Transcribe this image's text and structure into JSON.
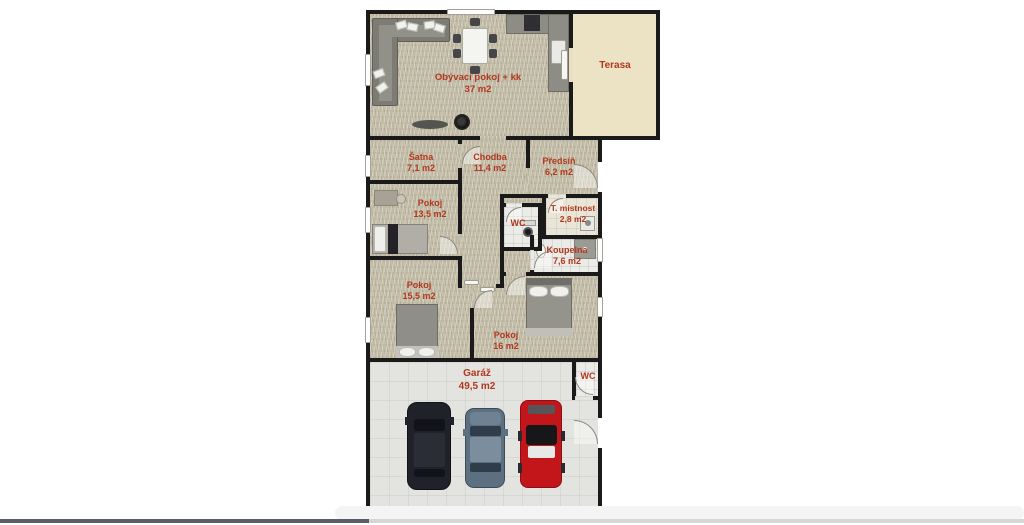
{
  "page": {
    "background_color": "#ffffff"
  },
  "floorplan": {
    "wall_color": "#1a1a1a",
    "label_color": "#b2371e",
    "rooms": [
      {
        "name": "Obývací pokoj + kk",
        "area": "37 m2"
      },
      {
        "name": "Terasa",
        "area": ""
      },
      {
        "name": "Šatna",
        "area": "7,1 m2"
      },
      {
        "name": "Chodba",
        "area": "11,4 m2"
      },
      {
        "name": "Předsíň",
        "area": "6,2 m2"
      },
      {
        "name": "Pokoj",
        "area": "13,5 m2"
      },
      {
        "name": "WC",
        "area": ""
      },
      {
        "name": "T. místnost",
        "area": "2,8 m2"
      },
      {
        "name": "Koupelna",
        "area": "7,6 m2"
      },
      {
        "name": "Pokoj",
        "area": "15,5 m2"
      },
      {
        "name": "Pokoj",
        "area": "16 m2"
      },
      {
        "name": "Garáž",
        "area": "49,5 m2"
      },
      {
        "name": "WC",
        "area": ""
      }
    ],
    "floor_colors": {
      "carpet": "#c7c1ac",
      "terrace": "#ece3c5",
      "bath_tile": "#ebebe7",
      "utility_tile": "#e9e6d8",
      "garage_tile": "#e3e3df"
    },
    "cars": [
      {
        "type": "suv",
        "color": "#20222a"
      },
      {
        "type": "sedan",
        "color": "#5c7082"
      },
      {
        "type": "sports-car",
        "color": "#c3161b"
      }
    ]
  },
  "player": {
    "progress_fraction": 0.36,
    "watched_color": "#5a5e62",
    "remaining_color": "#d6d6d8"
  }
}
